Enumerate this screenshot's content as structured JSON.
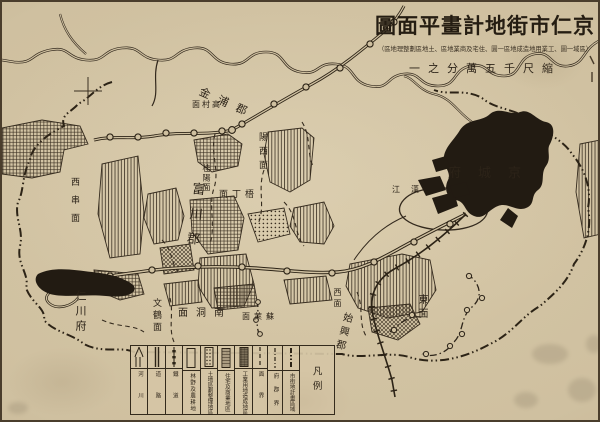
{
  "sheet": {
    "title_display": "圖面平畫計地街市仁京",
    "subtitle_display": "（區地理整劃區地土、區地業商及宅住、圜一區地成造地用業工、圜一域區）",
    "scale_display": "一之分萬五千尺縮"
  },
  "legend": {
    "title": "凡例",
    "items": [
      {
        "label": "河川",
        "symbol": "river-symbol"
      },
      {
        "label": "道路",
        "symbol": "road-symbol"
      },
      {
        "label": "鐵道",
        "symbol": "railway-symbol"
      },
      {
        "label": "林野及農耕地",
        "symbol": "plain-rect-symbol"
      },
      {
        "label": "土地區劃整理地區",
        "symbol": "dotted-rect-symbol"
      },
      {
        "label": "住宅及商業地區",
        "symbol": "grid-rect-symbol"
      },
      {
        "label": "工業用地造成地區",
        "symbol": "shaded-rect-symbol"
      },
      {
        "label": "面界",
        "symbol": "dashed-line-symbol"
      },
      {
        "label": "府郡界",
        "symbol": "dash-dot-line-symbol"
      },
      {
        "label": "市街地計畫區域",
        "symbol": "dash-dot-dot-line-symbol"
      }
    ]
  },
  "map_labels": [
    {
      "name": "kimpo-gun",
      "text": "金浦郡"
    },
    {
      "name": "kochon-myon",
      "text": "面村高"
    },
    {
      "name": "yangso-myon",
      "text": "陽西面"
    },
    {
      "name": "keyang-myon",
      "text": "桂陽面"
    },
    {
      "name": "ojong-myon",
      "text": "面丁梧"
    },
    {
      "name": "fusen-gun",
      "text": "富川郡"
    },
    {
      "name": "sokot-myon",
      "text": "西串面"
    },
    {
      "name": "jinsen-fu",
      "text": "仁川府"
    },
    {
      "name": "bunkaku-myon",
      "text": "文鶴面"
    },
    {
      "name": "namdong-myon",
      "text": "面洞南"
    },
    {
      "name": "sorai-myon",
      "text": "面萊蘇"
    },
    {
      "name": "so-myon",
      "text": "西面"
    },
    {
      "name": "shiko-gun",
      "text": "始興郡"
    },
    {
      "name": "dong-myon",
      "text": "東面"
    },
    {
      "name": "keijo-fu",
      "text": "府城京"
    },
    {
      "name": "han-river",
      "text": "江漢"
    }
  ],
  "colors": {
    "paper": "#cfc0a0",
    "ink": "#33291d",
    "built_up_black": "#221b12"
  }
}
